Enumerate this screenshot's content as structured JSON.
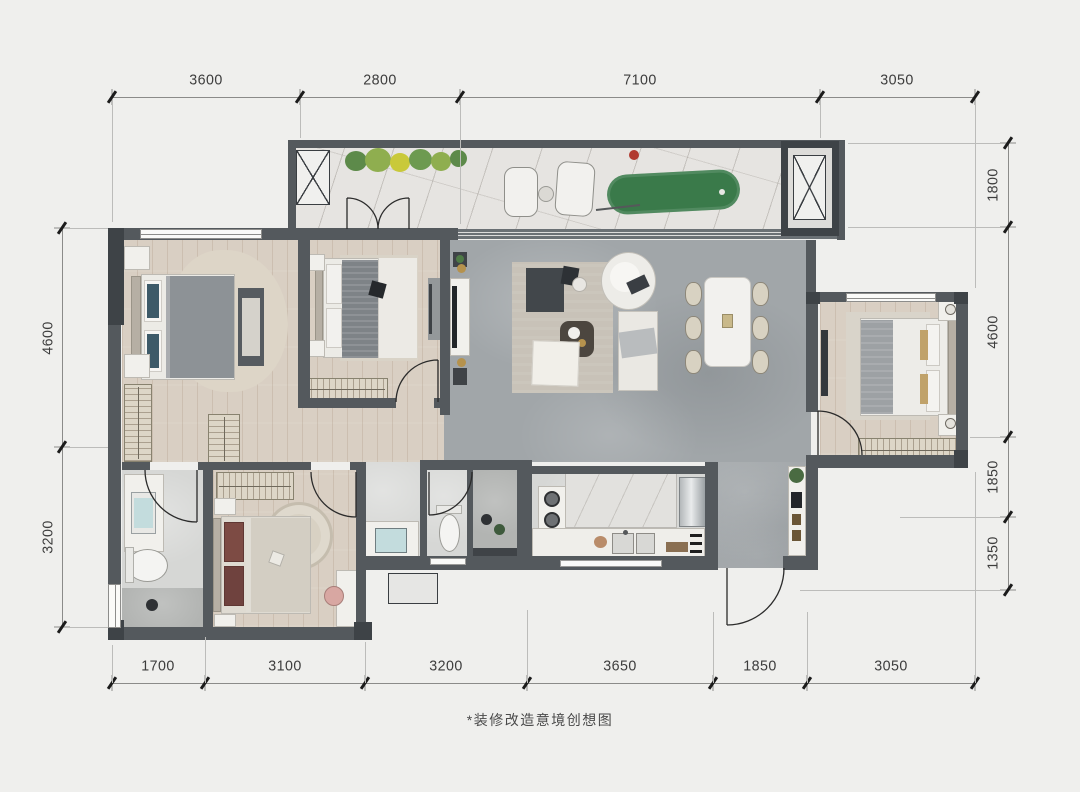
{
  "caption": "*装修改造意境创想图",
  "dims": {
    "top": [
      "3600",
      "2800",
      "7100",
      "3050"
    ],
    "bottom": [
      "1700",
      "3100",
      "3200",
      "3650",
      "1850",
      "3050"
    ],
    "left": [
      "4600",
      "3200"
    ],
    "right": [
      "1800",
      "4600",
      "1850",
      "1350"
    ]
  },
  "colors": {
    "wall": "#54595d",
    "wood_floor": "#d9cfc3",
    "stone_floor": "#a1a6a9",
    "balcony_floor": "#e6e4e1",
    "golf_green": "#3a7a4a",
    "accent_teal": "#3d5a68",
    "accent_maroon": "#7d4b44"
  }
}
